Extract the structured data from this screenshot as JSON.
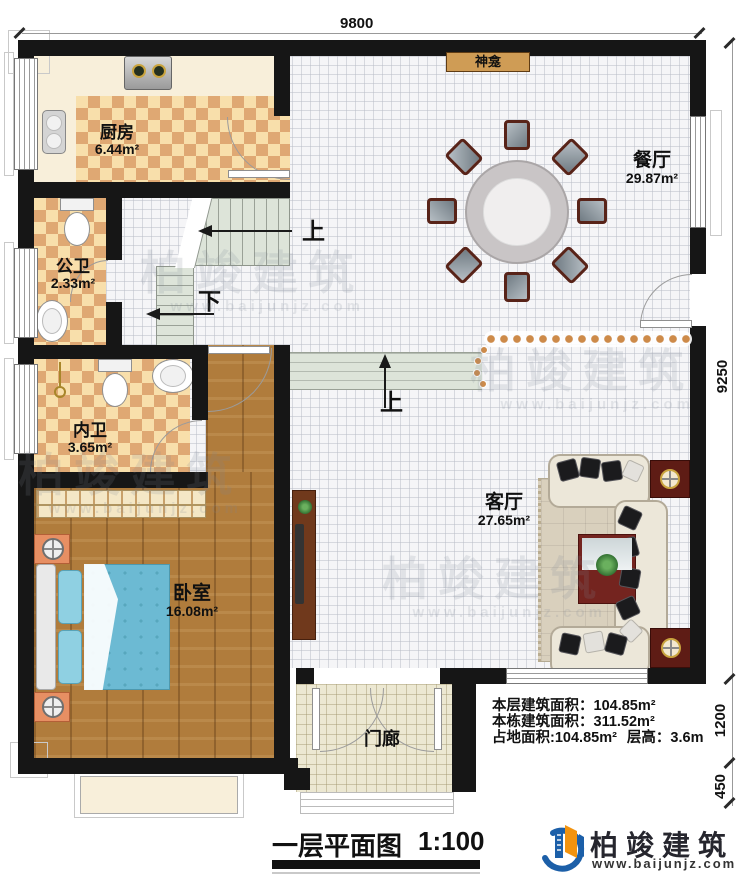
{
  "title": "一层平面图",
  "scale": "1:100",
  "dims": {
    "width": "9800",
    "height": "9250",
    "porch_depth": "1200",
    "step_depth": "450"
  },
  "rooms": {
    "kitchen": {
      "name": "厨房",
      "area": "6.44m²"
    },
    "public_bath": {
      "name": "公卫",
      "area": "2.33m²"
    },
    "private_bath": {
      "name": "内卫",
      "area": "3.65m²"
    },
    "bedroom": {
      "name": "卧室",
      "area": "16.08m²"
    },
    "dining": {
      "name": "餐厅",
      "area": "29.87m²"
    },
    "living": {
      "name": "客厅",
      "area": "27.65m²"
    },
    "porch": {
      "name": "门廊"
    },
    "shrine": {
      "name": "神龛"
    }
  },
  "stairs": {
    "up_main": "上",
    "down": "下",
    "up_entry": "上"
  },
  "info": {
    "floor_area_label": "本层建筑面积：",
    "floor_area_value": "104.85m²",
    "total_area_label": "本栋建筑面积：",
    "total_area_value": "311.52m²",
    "land_area_label": "占地面积:",
    "land_area_value": "104.85m²",
    "story_height_label": "层高：",
    "story_height_value": "3.6m"
  },
  "brand": {
    "name": "柏竣建筑",
    "url": "www.baijunjz.com"
  },
  "watermark": {
    "text": "柏竣建筑",
    "url": "www.baijunjz.com"
  },
  "colors": {
    "wall": "#161616",
    "checker_dark": "#dfa873",
    "checker_light": "#f8dfab",
    "wood": "#b07c3c",
    "bed": "#6cbad3",
    "stair_fill": "#dde4d9",
    "shrine": "#cf9c55",
    "logo_blue": "#1c5fa8",
    "logo_orange": "#f2930f"
  }
}
